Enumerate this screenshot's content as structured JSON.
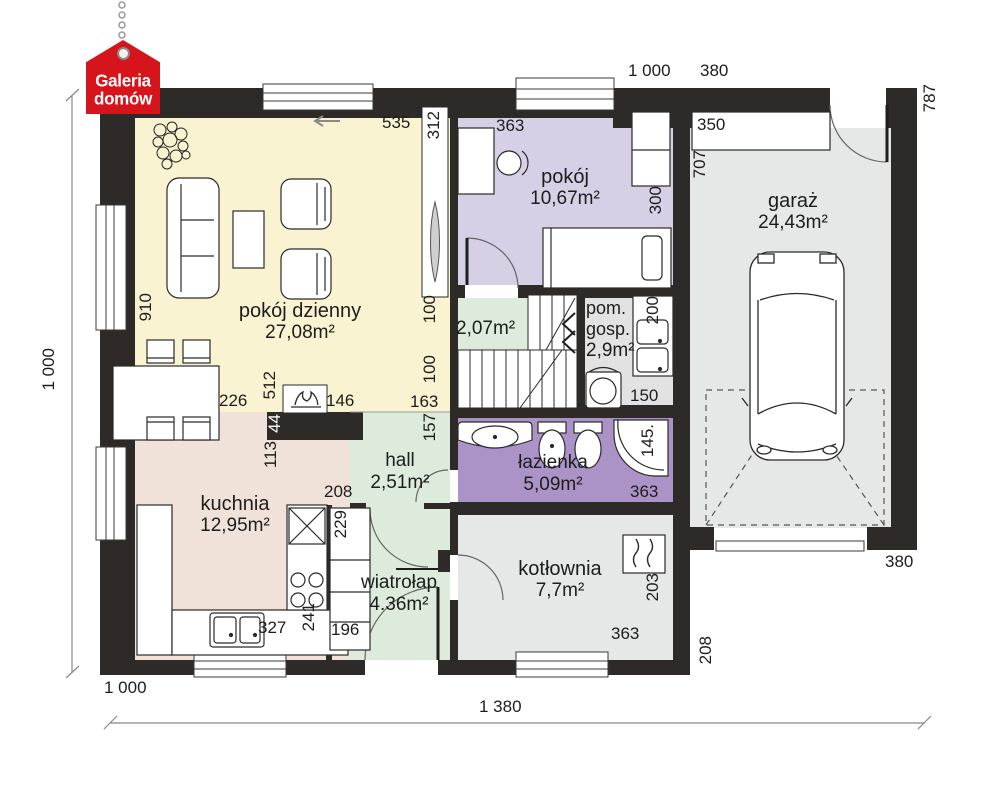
{
  "logo": {
    "line1": "Galeria",
    "line2": "domów"
  },
  "rooms": [
    {
      "id": "living",
      "name": "pokój dzienny",
      "area": "27,08m²"
    },
    {
      "id": "bedroom",
      "name": "pokój",
      "area": "10,67m²"
    },
    {
      "id": "garage",
      "name": "garaż",
      "area": "24,43m²"
    },
    {
      "id": "kitchen",
      "name": "kuchnia",
      "area": "12,95m²"
    },
    {
      "id": "hall",
      "name": "hall",
      "area": "2,51m²"
    },
    {
      "id": "vestibule",
      "name": "wiatrołap",
      "area": "4.36m²"
    },
    {
      "id": "bathroom",
      "name": "łazienka",
      "area": "5,09m²"
    },
    {
      "id": "boiler-room",
      "name": "kotłownia",
      "area": "7,7m²"
    },
    {
      "id": "utility",
      "name": "pom. gosp.",
      "area": "2,9m²"
    },
    {
      "id": "staircase",
      "name": "",
      "area": "2,07m²"
    }
  ],
  "dimensions": [
    {
      "t": "1 000",
      "x": 628,
      "y": 62
    },
    {
      "t": "380",
      "x": 700,
      "y": 62
    },
    {
      "t": "787",
      "x": 921,
      "y": 84,
      "v": 1
    },
    {
      "t": "350",
      "x": 697,
      "y": 116
    },
    {
      "t": "707",
      "x": 691,
      "y": 150,
      "v": 1
    },
    {
      "t": "363",
      "x": 496,
      "y": 117
    },
    {
      "t": "300",
      "x": 647,
      "y": 186,
      "v": 1
    },
    {
      "t": "535",
      "x": 382,
      "y": 114
    },
    {
      "t": "312",
      "x": 425,
      "y": 111,
      "v": 1
    },
    {
      "t": "910",
      "x": 137,
      "y": 293,
      "v": 1
    },
    {
      "t": "100",
      "x": 421,
      "y": 295,
      "v": 1
    },
    {
      "t": "100",
      "x": 421,
      "y": 355,
      "v": 1
    },
    {
      "t": "163",
      "x": 410,
      "y": 393
    },
    {
      "t": "157",
      "x": 421,
      "y": 413,
      "v": 1
    },
    {
      "t": "226",
      "x": 219,
      "y": 392
    },
    {
      "t": "512",
      "x": 261,
      "y": 371,
      "v": 1
    },
    {
      "t": "146",
      "x": 326,
      "y": 392
    },
    {
      "t": "44",
      "x": 266,
      "y": 414,
      "v": 1,
      "inv": 1
    },
    {
      "t": "113",
      "x": 262,
      "y": 441,
      "v": 1
    },
    {
      "t": "208",
      "x": 324,
      "y": 483
    },
    {
      "t": "229",
      "x": 332,
      "y": 510,
      "v": 1
    },
    {
      "t": "241",
      "x": 300,
      "y": 603,
      "v": 1
    },
    {
      "t": "327",
      "x": 258,
      "y": 619
    },
    {
      "t": "196",
      "x": 331,
      "y": 621
    },
    {
      "t": "200",
      "x": 644,
      "y": 296,
      "v": 1
    },
    {
      "t": "150",
      "x": 630,
      "y": 387
    },
    {
      "t": "145.",
      "x": 639,
      "y": 424,
      "v": 1
    },
    {
      "t": "363",
      "x": 630,
      "y": 483
    },
    {
      "t": "203",
      "x": 644,
      "y": 573,
      "v": 1
    },
    {
      "t": "363",
      "x": 611,
      "y": 625
    },
    {
      "t": "380",
      "x": 885,
      "y": 553
    },
    {
      "t": "208",
      "x": 697,
      "y": 636,
      "v": 1
    },
    {
      "t": "1 000",
      "x": 40,
      "y": 348,
      "v": 1
    },
    {
      "t": "1 000",
      "x": 104,
      "y": 679
    },
    {
      "t": "1 380",
      "x": 479,
      "y": 698
    }
  ],
  "colors": {
    "wall": "#2d2a27",
    "living": "#faf3d1",
    "kitchen": "#f0e2d9",
    "green": "#dcebdc",
    "bedroom": "#d7cfe5",
    "bathroom": "#ab93c8",
    "utility": "#e2e2e2",
    "garage": "#e6e7e7",
    "boiler_room": "#e6e7e7",
    "logo_red": "#d6141c"
  }
}
